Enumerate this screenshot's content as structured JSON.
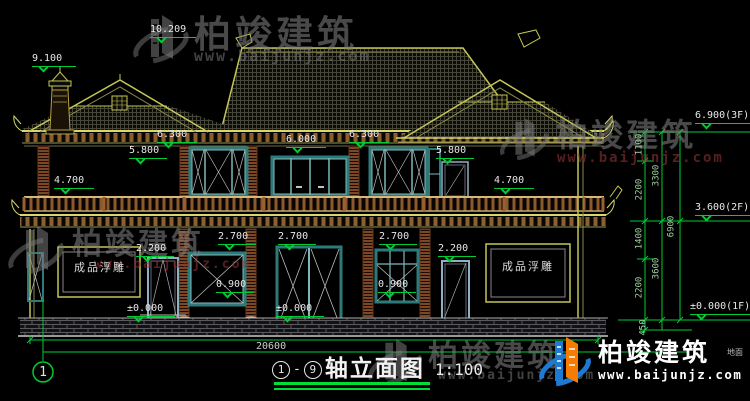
{
  "drawing": {
    "type": "elevation",
    "scale_note": "CAD house elevation drawing, black background, green dimension lines"
  },
  "title": {
    "axis_start": "1",
    "separator": "-",
    "axis_end": "9",
    "text": "轴立面图",
    "scale": "1:100"
  },
  "markers": {
    "m10209": "10.209",
    "m9100": "9.100",
    "m6300_l": "6.300",
    "m6300_r": "6.300",
    "m6000": "6.000",
    "m5800_l": "5.800",
    "m5800_r": "5.800",
    "m4700_l": "4.700",
    "m4700_r": "4.700",
    "m2700_a": "2.700",
    "m2700_b": "2.700",
    "m2700_c": "2.700",
    "m2200_l": "2.200",
    "m2200_r": "2.200",
    "m0900_l": "0.900",
    "m0900_r": "0.900",
    "m0000_l": "±0.000",
    "m0000_c": "±0.000"
  },
  "right_chain": {
    "f3": "6.900(3F)",
    "f2": "3.600(2F)",
    "f1": "±0.000(1F)",
    "d1100": "1100",
    "d2200_upper": "2200",
    "d1400": "1400",
    "d2200_lower": "2200",
    "d450": "450",
    "d3300": "3300",
    "d3600": "3600",
    "d6900": "6900",
    "ground": "地面"
  },
  "bottom": {
    "total_width": "20600",
    "axis_number": "1"
  },
  "panels": {
    "relief": "成品浮雕"
  },
  "watermarks": {
    "brand": "柏竣建筑",
    "url": "www.baijunjz.com"
  },
  "logo": {
    "brand": "柏竣建筑",
    "url": "www.baijunjz.com"
  },
  "colors": {
    "dim_green": "#00cc33",
    "line_yellow": "#c6c655",
    "frame_teal": "#2e7a7a",
    "brick_brown": "#8a4f2a",
    "logo_blue": "#1e7ad0",
    "logo_orange": "#f57c00"
  }
}
